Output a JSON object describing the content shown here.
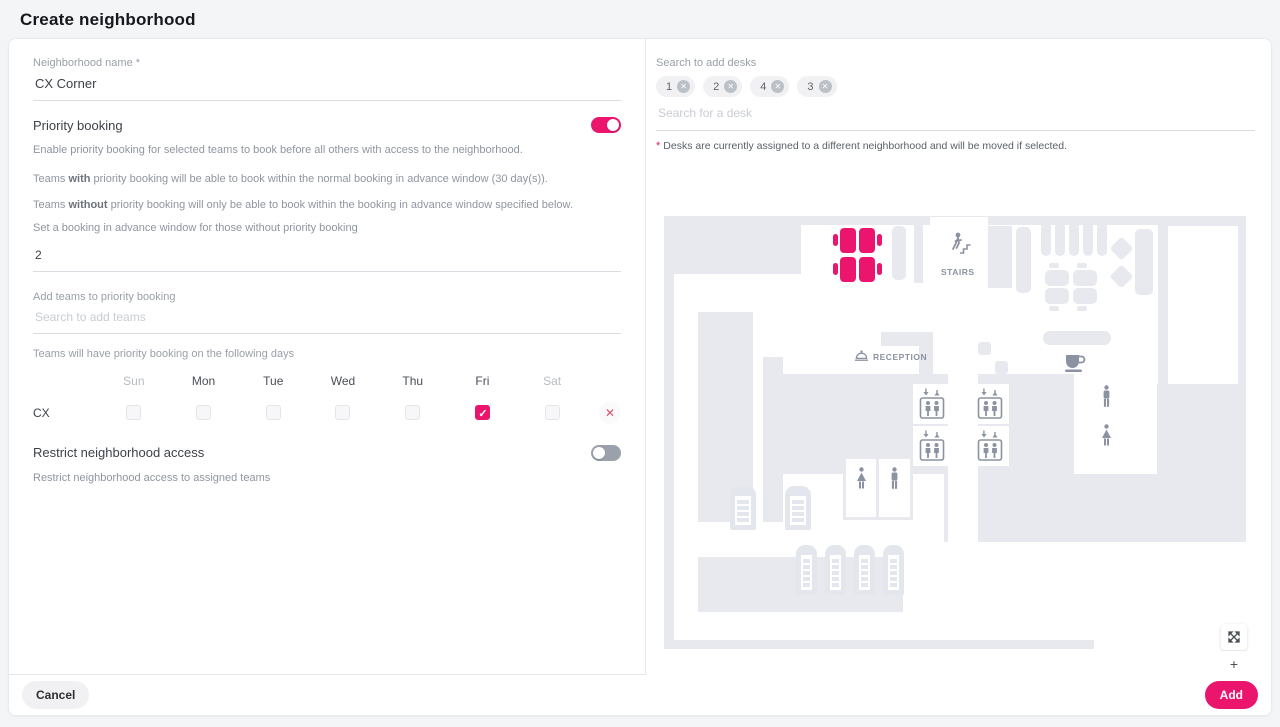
{
  "page": {
    "title": "Create neighborhood"
  },
  "colors": {
    "accent": "#ec156e",
    "map_shape": "#e7e9ee",
    "map_icon": "#8b92a1",
    "error_red": "#e8175d"
  },
  "left_panel": {
    "name_field": {
      "label": "Neighborhood name *",
      "value": "CX Corner"
    },
    "priority_booking": {
      "title": "Priority booking",
      "toggle_on": true,
      "description": "Enable priority booking for selected teams to book before all others with access to the neighborhood.",
      "with_prefix": "Teams ",
      "with_bold": "with",
      "with_suffix": " priority booking will be able to book within the normal booking in advance window (30 day(s)).",
      "without_prefix": "Teams ",
      "without_bold": "without",
      "without_suffix": " priority booking will only be able to book within the booking in advance window specified below.",
      "advance_label": "Set a booking in advance window for those without priority booking",
      "advance_value": "2",
      "add_teams_label": "Add teams to priority booking",
      "add_teams_placeholder": "Search to add teams",
      "days_label": "Teams will have priority booking on the following days",
      "days": [
        "Sun",
        "Mon",
        "Tue",
        "Wed",
        "Thu",
        "Fri",
        "Sat"
      ],
      "team_rows": [
        {
          "team": "CX",
          "checked": [
            false,
            false,
            false,
            false,
            false,
            true,
            false
          ]
        }
      ]
    },
    "restrict": {
      "title": "Restrict neighborhood access",
      "toggle_on": false,
      "description": "Restrict neighborhood access to assigned teams"
    }
  },
  "right_panel": {
    "search_label": "Search to add desks",
    "chips": [
      "1",
      "2",
      "4",
      "3"
    ],
    "search_placeholder": "Search for a desk",
    "note_star": "*",
    "note_text": "Desks are currently assigned to a different neighborhood and will be moved if selected.",
    "map": {
      "stairs_label": "STAIRS",
      "reception_label": "RECEPTION"
    },
    "controls": {
      "zoom_in_glyph": "+"
    }
  },
  "icons": {
    "close_glyph": "✕"
  },
  "footer": {
    "cancel_label": "Cancel",
    "add_label": "Add"
  }
}
